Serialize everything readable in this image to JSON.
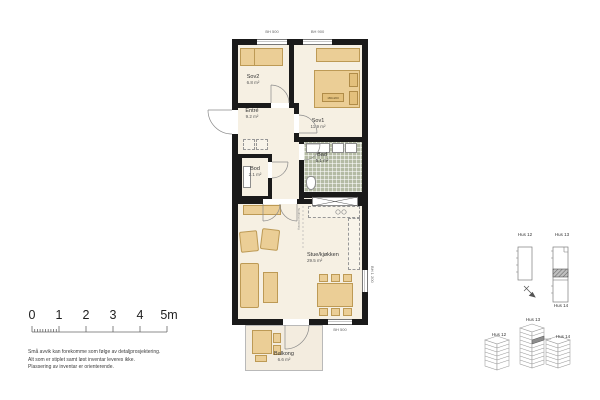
{
  "plan": {
    "rooms": {
      "sov2": {
        "name": "Sov2",
        "area": "6.8 m²"
      },
      "sov1": {
        "name": "Sov1",
        "area": "11.9 m²"
      },
      "entre": {
        "name": "Entré",
        "area": "9.2 m²"
      },
      "bod": {
        "name": "Bod",
        "area": "2.1 m²"
      },
      "bad": {
        "name": "Bad",
        "area": "5.1 m²"
      },
      "stue": {
        "name": "Stue/kjøkken",
        "area": "29.5 m²"
      },
      "balkong": {
        "name": "Balkong",
        "area": "6.6 m²"
      }
    },
    "annotations": {
      "bh_top_left": "BH 500",
      "bh_top_right": "BH 900",
      "bh_right": "BH 1 200",
      "bh_bottom": "BH 500",
      "bed_size": "180x200",
      "ceiling_note": "Nedforet himling"
    }
  },
  "scalebar": {
    "labels": [
      "0",
      "1",
      "2",
      "3",
      "4",
      "5m"
    ]
  },
  "disclaimer": {
    "line1": "Små avvik kan forekomme som følge av detaljprosjektering.",
    "line2": "Alt som er stiplet samt løst inventar leveres ikke.",
    "line3": "Plassering av inventar er orienterende."
  },
  "siteplan": {
    "hus12": "Hus 12",
    "hus13": "Hus 13",
    "hus14": "Hus 14"
  },
  "axonometric": {
    "hus12": "Hus 12",
    "hus13": "Hus 13",
    "hus14": "Hus 14"
  },
  "colors": {
    "wall": "#1a1a1a",
    "floor": "#f6f0e3",
    "furniture": "#ebce96",
    "bath_tile": "#b4bba4",
    "highlight_unit": "#9a9a9a"
  }
}
